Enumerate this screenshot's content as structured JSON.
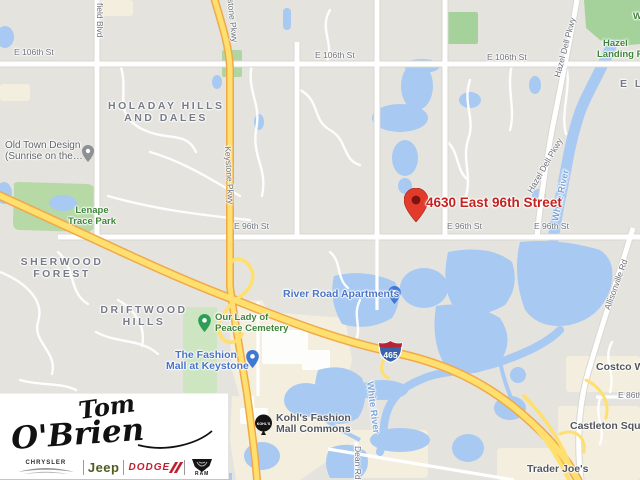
{
  "map": {
    "marker": {
      "label": "4630 East 96th Street"
    },
    "shield": {
      "number": "465"
    },
    "streets": {
      "e106": "E 106th St",
      "e96": "E 96th St",
      "e86": "E 86th St",
      "keystone": "Keystone Pkwy",
      "westfield_partial": "field Blvd",
      "hazel_dell": "Hazel Dell Pkwy",
      "allisonville": "Allisonville Rd",
      "dean": "Dean Rd"
    },
    "neighborhoods": {
      "holaday_1": "HOLADAY HILLS",
      "holaday_2": "AND DALES",
      "sherwood_1": "SHERWOOD",
      "sherwood_2": "FOREST",
      "driftwood_1": "DRIFTWOOD",
      "driftwood_2": "HILLS",
      "el_partial": "E L"
    },
    "parks": {
      "lenape_1": "Lenape",
      "lenape_2": "Trace Park",
      "hazel_landing_1": "Hazel",
      "hazel_landing_2": "Landing Park",
      "cemetery_1": "Our Lady of",
      "cemetery_2": "Peace Cemetery",
      "w_partial": "W"
    },
    "water_labels": {
      "white_river": "White River"
    },
    "places": {
      "old_town_1": "Old Town Design",
      "old_town_2": "(Sunrise on the…",
      "river_road_apartments": "River Road Apartments",
      "fashion_mall_1": "The Fashion",
      "fashion_mall_2": "Mall at Keystone",
      "kohls_1": "Kohl's Fashion",
      "kohls_2": "Mall Commons",
      "kohls_icon_text": "KOHL'S",
      "costco": "Costco Wholesale",
      "castleton": "Castleton Square",
      "trader_joes": "Trader Joe's"
    },
    "colors": {
      "water": "#a8c9f2",
      "park_dark": "#a5d29b",
      "park_light": "#cee5c2",
      "commercial": "#f3eedd",
      "highway_fill": "#ffdf6e",
      "highway_casing": "#efa94a",
      "marker_red": "#e23b2c",
      "marker_text_red": "#c5221f",
      "poi_blue": "#4a74c6",
      "park_text_green": "#40843c"
    }
  },
  "logo": {
    "dealer_line1": "Tom",
    "dealer_line2": "O'Brien",
    "brands": {
      "chrysler": "CHRYSLER",
      "jeep": "Jeep",
      "dodge": "DODGE",
      "ram": "RAM"
    }
  }
}
